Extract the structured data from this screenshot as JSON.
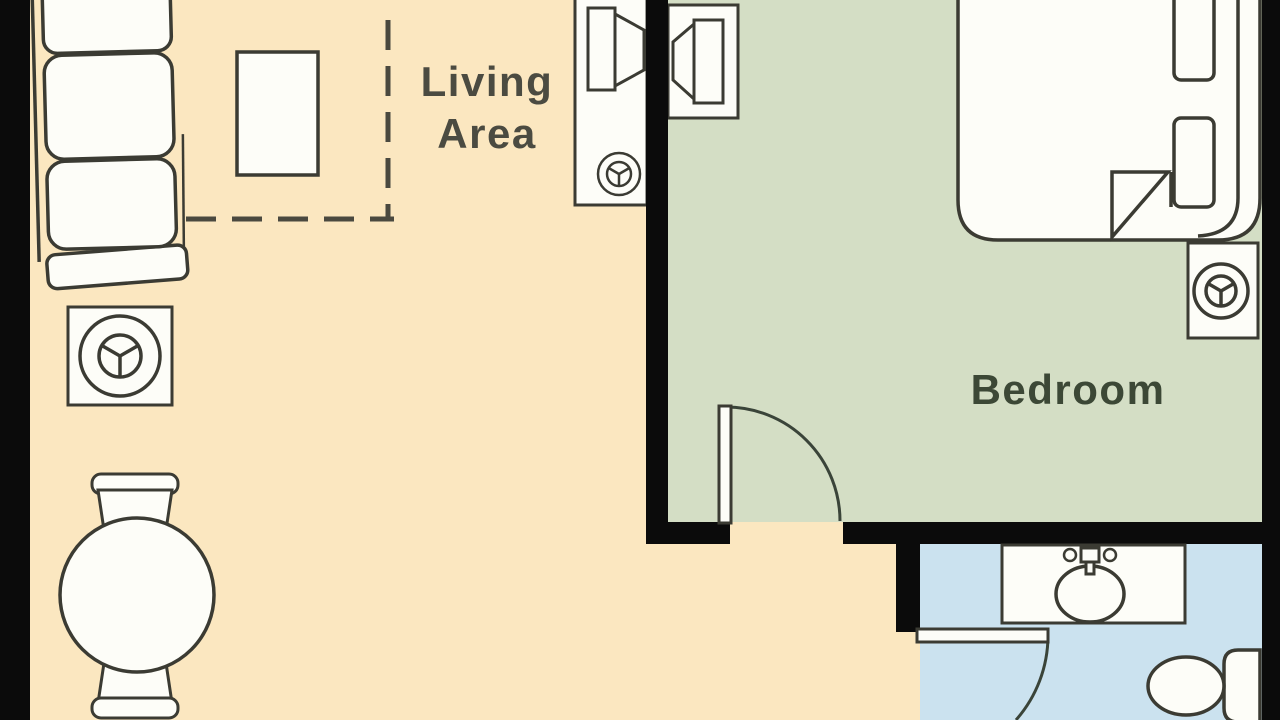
{
  "plan": {
    "wall_color": "#0b0b0b",
    "rooms": {
      "living": {
        "label_line1": "Living",
        "label_line2": "Area",
        "floor_color": "#fbe7c0",
        "label_color": "#4b4b41"
      },
      "bedroom": {
        "label": "Bedroom",
        "floor_color": "#d4dec5",
        "label_color": "#3c4836"
      },
      "bathroom": {
        "floor_color": "#cbe2ef"
      }
    },
    "fixtures": [
      "sofa",
      "coffee-table",
      "side-table-with-lamp",
      "tv-console-living",
      "tv-console-bedroom",
      "dining-table-with-chairs",
      "bed-with-pillows",
      "nightstand-with-lamp",
      "bedroom-door",
      "bathroom-door",
      "bathroom-vanity-sink",
      "toilet"
    ]
  }
}
